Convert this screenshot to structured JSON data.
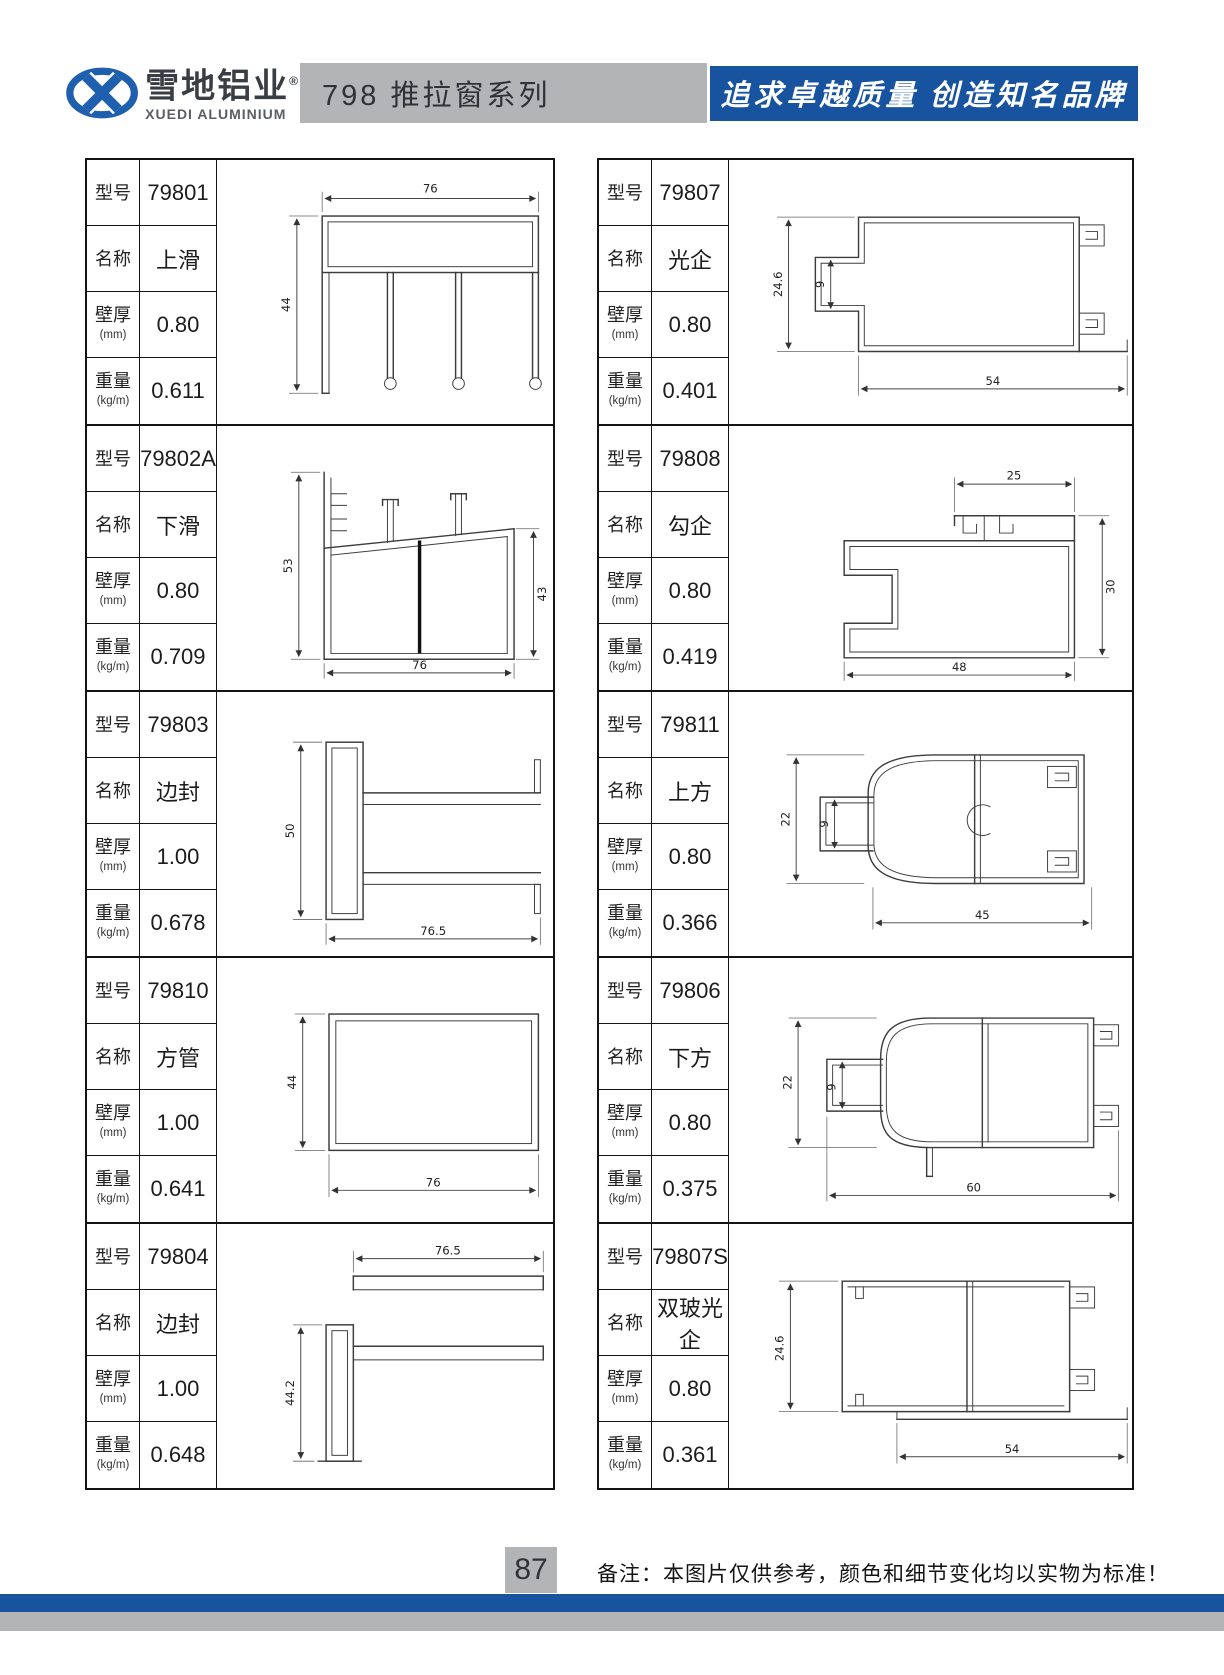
{
  "header": {
    "brand_cn": "雪地铝业",
    "brand_reg": "®",
    "brand_en": "XUEDI ALUMINIUM",
    "series_title": "798 推拉窗系列",
    "slogan": "追求卓越质量 创造知名品牌",
    "colors": {
      "logo_blue": "#1e5fae",
      "title_bar_gray": "#b2b4b6",
      "slogan_bar_blue": "#17539e"
    }
  },
  "labels": {
    "model": "型号",
    "name": "名称",
    "thickness": "壁厚",
    "thickness_unit": "(mm)",
    "weight": "重量",
    "weight_unit": "(kg/m)"
  },
  "products": {
    "left": [
      {
        "model": "79801",
        "name": "上滑",
        "thickness": "0.80",
        "weight": "0.611",
        "dims": {
          "top": "76",
          "left": "44"
        }
      },
      {
        "model": "79802A",
        "name": "下滑",
        "thickness": "0.80",
        "weight": "0.709",
        "dims": {
          "left": "53",
          "right": "43",
          "bottom": "76"
        }
      },
      {
        "model": "79803",
        "name": "边封",
        "thickness": "1.00",
        "weight": "0.678",
        "dims": {
          "left": "50",
          "bottom": "76.5"
        }
      },
      {
        "model": "79810",
        "name": "方管",
        "thickness": "1.00",
        "weight": "0.641",
        "dims": {
          "left": "44",
          "bottom": "76"
        }
      },
      {
        "model": "79804",
        "name": "边封",
        "thickness": "1.00",
        "weight": "0.648",
        "dims": {
          "top": "76.5",
          "left": "44.2"
        }
      }
    ],
    "right": [
      {
        "model": "79807",
        "name": "光企",
        "thickness": "0.80",
        "weight": "0.401",
        "dims": {
          "left": "24.6",
          "inner": "9",
          "bottom": "54"
        }
      },
      {
        "model": "79808",
        "name": "勾企",
        "thickness": "0.80",
        "weight": "0.419",
        "dims": {
          "top": "25",
          "right": "30",
          "bottom": "48"
        }
      },
      {
        "model": "79811",
        "name": "上方",
        "thickness": "0.80",
        "weight": "0.366",
        "dims": {
          "left": "22",
          "inner": "9",
          "bottom": "45"
        }
      },
      {
        "model": "79806",
        "name": "下方",
        "thickness": "0.80",
        "weight": "0.375",
        "dims": {
          "left": "22",
          "inner": "9",
          "bottom": "60"
        }
      },
      {
        "model": "79807S",
        "name": "双玻光企",
        "thickness": "0.80",
        "weight": "0.361",
        "dims": {
          "left": "24.6",
          "bottom": "54"
        }
      }
    ]
  },
  "footer": {
    "page_number": "87",
    "note": "备注：本图片仅供参考，颜色和细节变化均以实物为标准！"
  }
}
